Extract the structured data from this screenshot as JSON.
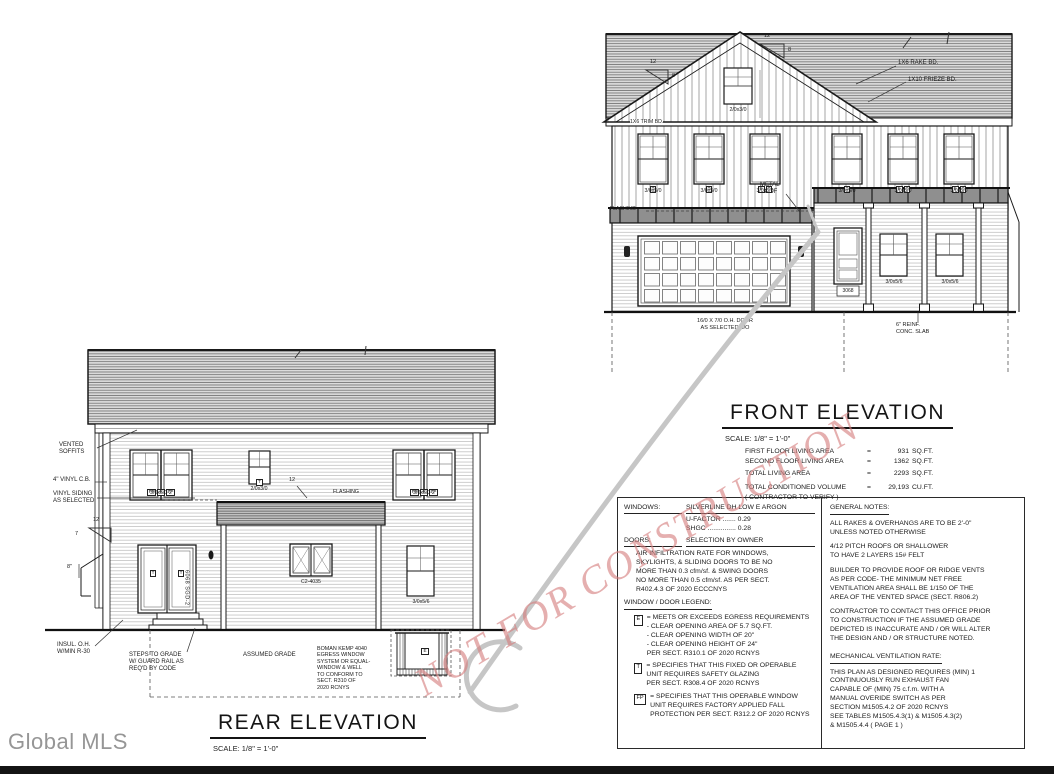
{
  "brand": {
    "logo": "Global MLS"
  },
  "watermark": {
    "text": "NOT FOR CONSTRUCTION"
  },
  "front": {
    "title": "FRONT ELEVATION",
    "scale": "SCALE: 1/8\" = 1'-0\"",
    "stats": {
      "rows": [
        {
          "label": "FIRST FLOOR LIVING AREA",
          "eq": "=",
          "value": "931",
          "unit": "SQ.FT."
        },
        {
          "label": "SECOND FLOOR LIVING AREA",
          "eq": "=",
          "value": "1362",
          "unit": "SQ.FT."
        },
        {
          "label": "TOTAL LIVING AREA",
          "eq": "=",
          "value": "2293",
          "unit": "SQ.FT."
        },
        {
          "label": "TOTAL CONDITIONED VOLUME",
          "eq": "=",
          "value": "29,193",
          "unit": "CU.FT."
        }
      ],
      "note": "( CONTRACTOR TO VERIFY )"
    },
    "labels": {
      "rake": "1X6 RAKE BD.",
      "frieze": "1X10 FRIEZE BD.",
      "trim": "1X6 TRIM BD.",
      "flashing": "FLASHING",
      "metal_roof": "METAL\nROOF",
      "gable_window": "2/0x3/0",
      "upper_window": "3/0x5/0",
      "porch_window": "3/0x5/6",
      "entry_door": "3068",
      "garage_door": "16/0 X 7/0 O.H. DOOR\nAS SELECTED B/O",
      "slab": "6\" REINF.\nCONC. SLAB",
      "pitch_run": "12",
      "pitch_rise": "8"
    }
  },
  "rear": {
    "title": "REAR ELEVATION",
    "scale": "SCALE: 1/8\" = 1'-0\"",
    "labels": {
      "soffits": "VENTED\nSOFFITS",
      "corner_board": "4\" VINYL C.B.",
      "siding": "VINYL SIDING\nAS SELECTED",
      "insulation": "INSUL. O.H.\nW/MIN R-30",
      "steps": "STEPS TO GRADE\nW/ GUARD RAIL AS\nREQ'D BY CODE",
      "grade": "ASSUMED GRADE",
      "egress": "BOMAN KEMP 4040\nEGRESS WINDOW\nSYSTEM OR EQUAL-\nWINDOW & WELL\nTO CONFORM TO\nSECT. R310 OF\n2020 RCNYS",
      "flashing": "FLASHING",
      "pair_window": "3/0x5/0-2",
      "small_window": "2/0x3/0",
      "casement": "C2-4035",
      "single_window": "3/0x5/6",
      "slider": "6068 SGD-2",
      "dim8": "8\"",
      "pitch_run": "12",
      "pitch_rise": "7"
    }
  },
  "specs": {
    "windows_heading": "WINDOWS:",
    "windows_value": "SILVERLINE DH LOW E ARGON",
    "u_factor": "U-FACTOR  .......  0.29",
    "shgc": "SHGC  ...............  0.28",
    "doors_heading": "DOORS:",
    "doors_value": "SELECTION BY OWNER",
    "air_note": "AIR INFILTRATION RATE FOR WINDOWS,\nSKYLIGHTS, & SLIDING DOORS TO BE NO\nMORE THAN 0.3 cfm/sf. & SWING DOORS\nNO MORE THAN 0.5 cfm/sf. AS PER SECT.\nR402.4.3 OF 2020 ECCCNYS",
    "legend_heading": "WINDOW / DOOR LEGEND:",
    "keys": {
      "e": "E",
      "t": "T",
      "fp": "FP"
    },
    "legend": [
      {
        "text": "= MEETS OR EXCEEDS EGRESS REQUIREMENTS\n- CLEAR OPENING AREA OF 5.7 SQ.FT.\n- CLEAR OPENING WIDTH OF 20\"\n- CLEAR OPENING HEIGHT OF 24\"\nPER SECT. R310.1 OF 2020 RCNYS"
      },
      {
        "text": "= SPECIFIES THAT THIS FIXED OR OPERABLE\nUNIT REQUIRES SAFETY GLAZING\nPER SECT. R308.4 OF 2020 RCNYS"
      },
      {
        "text": "= SPECIFIES THAT THIS OPERABLE WINDOW\nUNIT REQUIRES FACTORY APPLIED FALL\nPROTECTION PER SECT. R312.2 OF 2020 RCNYS"
      }
    ],
    "general_heading": "GENERAL NOTES:",
    "general": [
      "ALL RAKES & OVERHANGS ARE TO BE 2'-0\"\nUNLESS NOTED OTHERWISE",
      "4/12 PITCH ROOFS OR SHALLOWER\nTO HAVE 2 LAYERS 15# FELT",
      "BUILDER TO PROVIDE ROOF OR RIDGE VENTS\nAS PER CODE- THE MINIMUM NET FREE\nVENTILATION AREA SHALL BE 1/150 OF THE\nAREA OF THE VENTED SPACE (SECT. R806.2)",
      "CONTRACTOR TO CONTACT THIS OFFICE PRIOR\nTO CONSTRUCTION IF THE ASSUMED GRADE\nDEPICTED IS INACCURATE AND / OR  WILL ALTER\nTHE DESIGN AND / OR STRUCTURE NOTED."
    ],
    "mech_heading": "MECHANICAL VENTILATION RATE:",
    "mech_note": "THIS PLAN AS DESIGNED REQUIRES (MIN) 1\nCONTINUOUSLY RUN EXHAUST FAN\nCAPABLE OF (MIN) 75 c.f.m. WITH A\nMANUAL OVERIDE SWITCH AS PER\nSECTION M1505.4.2 OF 2020 RCNYS\nSEE TABLES M1505.4.3(1) & M1505.4.3(2)\n& M1505.4.4 ( PAGE 1 )"
  }
}
